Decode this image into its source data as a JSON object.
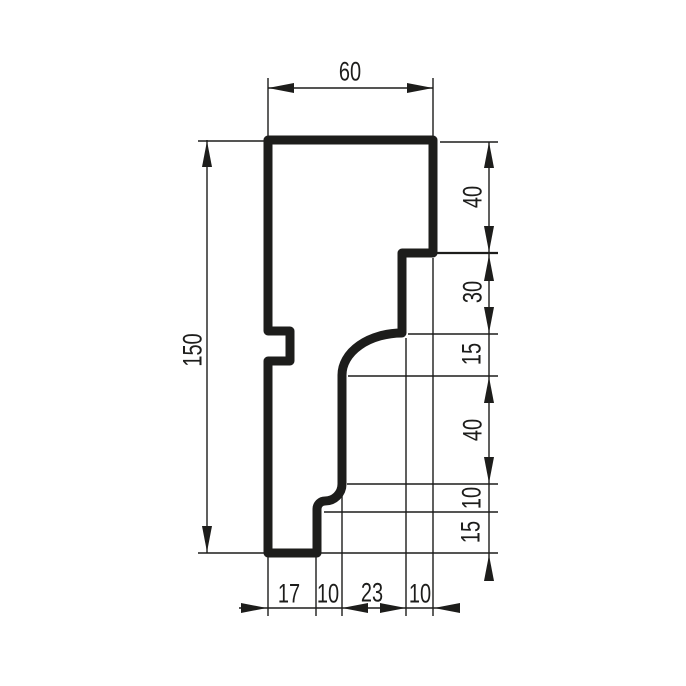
{
  "drawing": {
    "kind": "profile-cross-section-technical-drawing",
    "colors": {
      "ink": "#1d1d1b",
      "background": "#ffffff"
    },
    "dims": {
      "top_width": "60",
      "left_height": "150",
      "right_chain": [
        "40",
        "30",
        "15",
        "40",
        "10",
        "15"
      ],
      "bottom_chain": [
        "17",
        "10",
        "23",
        "10"
      ]
    }
  }
}
